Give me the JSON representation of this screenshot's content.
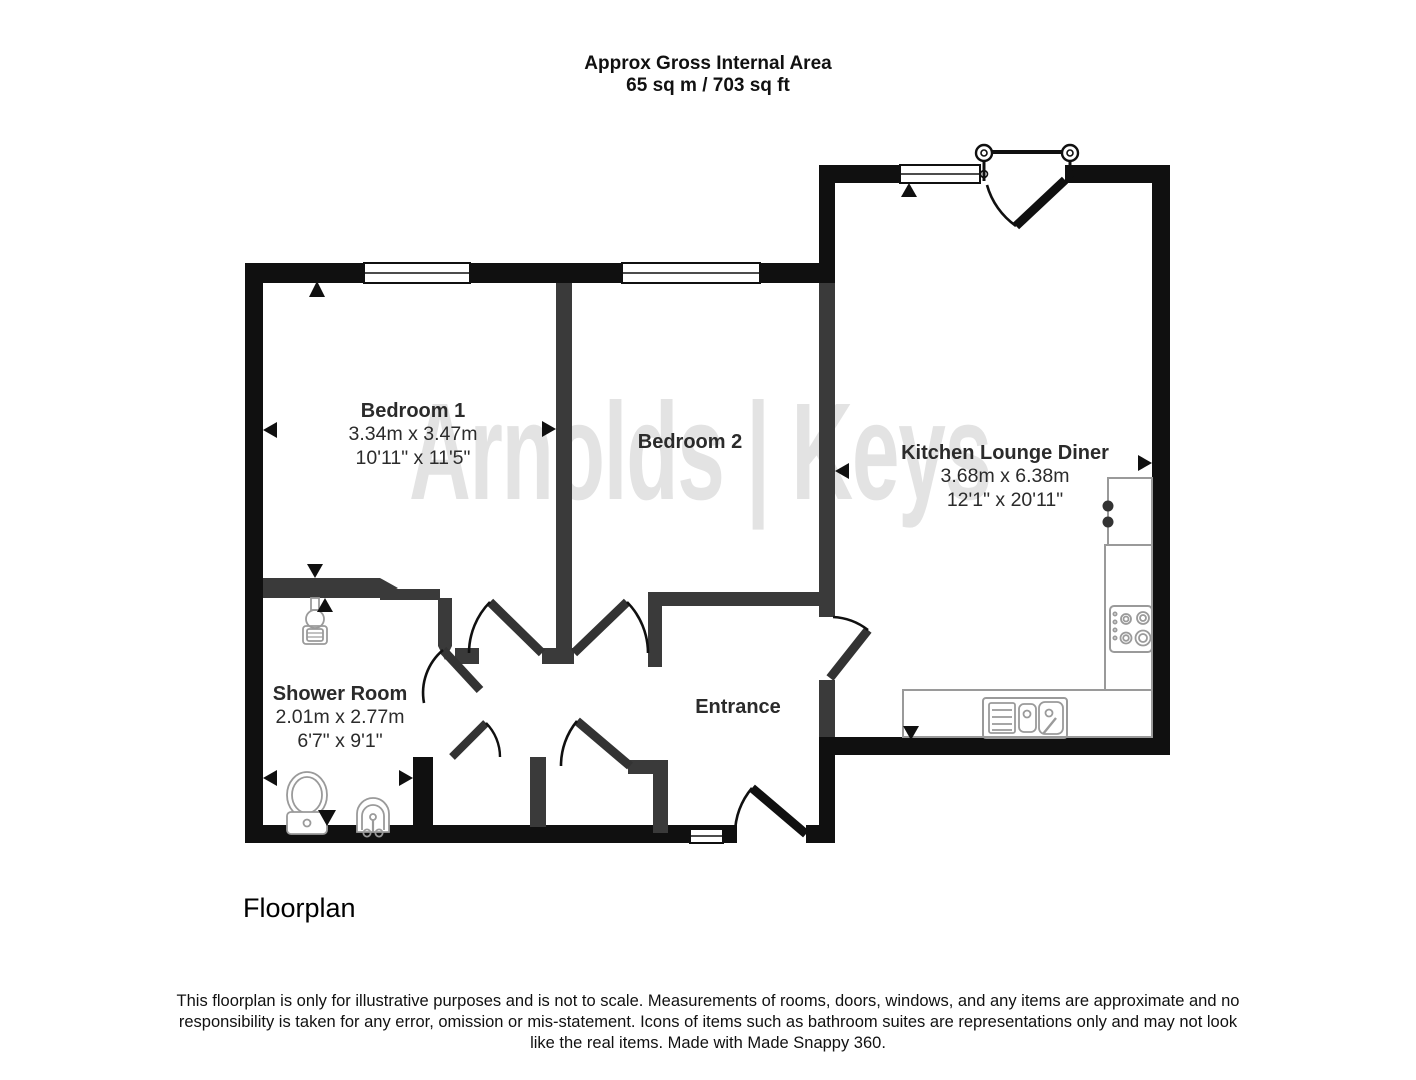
{
  "header": {
    "line1": "Approx Gross Internal Area",
    "line2": "65 sq m / 703 sq ft"
  },
  "watermark": "Arnolds | Keys",
  "caption": "Floorplan",
  "disclaimer": "This floorplan is only for illustrative purposes and is not to scale. Measurements of rooms, doors, windows, and any items are approximate and no responsibility is taken for any error, omission or mis-statement. Icons of items such as bathroom suites are representations only and may not look like the real items. Made with Made Snappy 360.",
  "rooms": [
    {
      "name": "Bedroom 1",
      "metric": "3.34m x 3.47m",
      "imperial": "10'11\" x 11'5\""
    },
    {
      "name": "Bedroom 2",
      "metric": "",
      "imperial": ""
    },
    {
      "name": "Kitchen Lounge Diner",
      "metric": "3.68m x 6.38m",
      "imperial": "12'1\" x 20'11\""
    },
    {
      "name": "Shower Room",
      "metric": "2.01m x 2.77m",
      "imperial": "6'7\" x 9'1\""
    },
    {
      "name": "Entrance",
      "metric": "",
      "imperial": ""
    }
  ],
  "icons": [
    "window-icon",
    "door-swing-icon",
    "juliet-balcony-railing-icon",
    "toilet-icon",
    "basin-icon",
    "shower-drain-icon",
    "kitchen-sink-icon",
    "hob-icon",
    "appliance-icon",
    "direction-marker-icon"
  ],
  "colors": {
    "exterior_wall": "#101010",
    "interior_wall": "#3a3a3a",
    "fixture_outline": "#9a9a9a",
    "watermark": "#e3e3e3",
    "background": "#ffffff"
  }
}
